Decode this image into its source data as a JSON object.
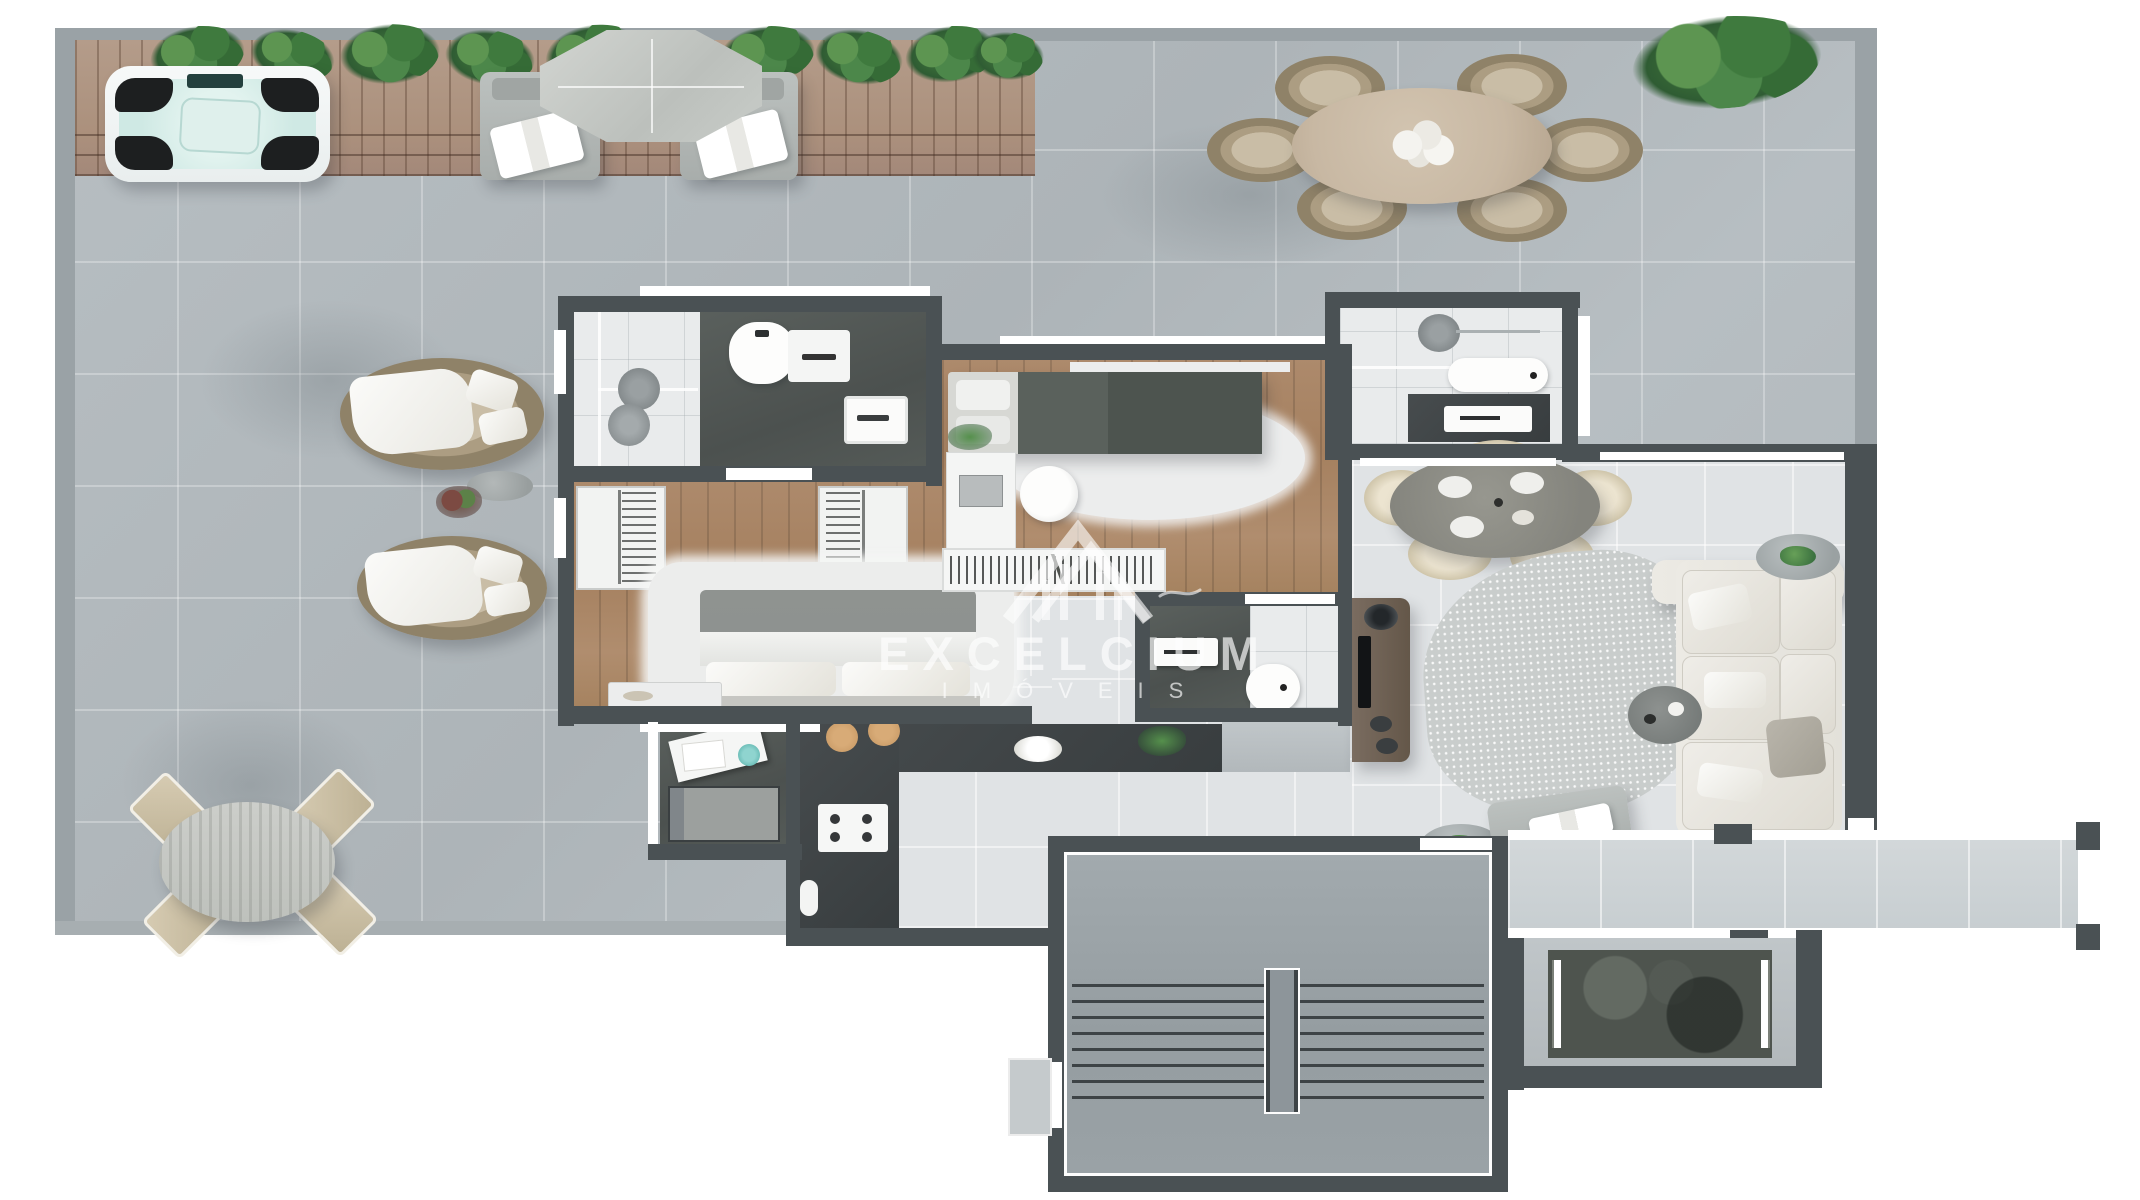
{
  "watermark": {
    "line1": "EXCELCIUM",
    "line2": "IMÓVEIS"
  },
  "palette": {
    "canvas": "#ffffff",
    "terrace_tile": "#b7bec2",
    "terrace_border": "#9aa2a6",
    "wall_dark": "#4a5154",
    "interior_tile": "#e0e3e5",
    "bathroom_tile": "#e9ebec",
    "wood_floor": "#aa8768",
    "deck_wood": "#b49c8a",
    "plant_green": "#47823f",
    "water_teal": "#cfe9e4",
    "rug_gray": "#c9cdcc",
    "sofa_cream": "#e9e8e2",
    "counter_dark": "#3e4345",
    "console_brown": "#6e6054",
    "table_tan": "#c8b8a3",
    "chair_cream": "#ece4d0",
    "stool_tan": "#c89a66",
    "stair_floor": "#9aa2a7",
    "elevator_dark": "#4e544e"
  },
  "decor": {
    "deck_plants": [
      {
        "x": 150,
        "y": 26,
        "w": 95,
        "h": 58,
        "r": -8
      },
      {
        "x": 250,
        "y": 30,
        "w": 85,
        "h": 52,
        "r": 12
      },
      {
        "x": 340,
        "y": 24,
        "w": 100,
        "h": 60,
        "r": -4
      },
      {
        "x": 445,
        "y": 30,
        "w": 90,
        "h": 55,
        "r": 8
      },
      {
        "x": 545,
        "y": 25,
        "w": 95,
        "h": 58,
        "r": -10
      },
      {
        "x": 640,
        "y": 32,
        "w": 80,
        "h": 50,
        "r": 5
      },
      {
        "x": 720,
        "y": 26,
        "w": 95,
        "h": 56,
        "r": -6
      },
      {
        "x": 815,
        "y": 30,
        "w": 88,
        "h": 54,
        "r": 10
      },
      {
        "x": 905,
        "y": 26,
        "w": 92,
        "h": 56,
        "r": -8
      },
      {
        "x": 972,
        "y": 32,
        "w": 72,
        "h": 48,
        "r": 4
      }
    ],
    "stair_treads": {
      "count": 8,
      "x": 1072,
      "width": 412,
      "y_start": 984,
      "step": 16
    }
  }
}
